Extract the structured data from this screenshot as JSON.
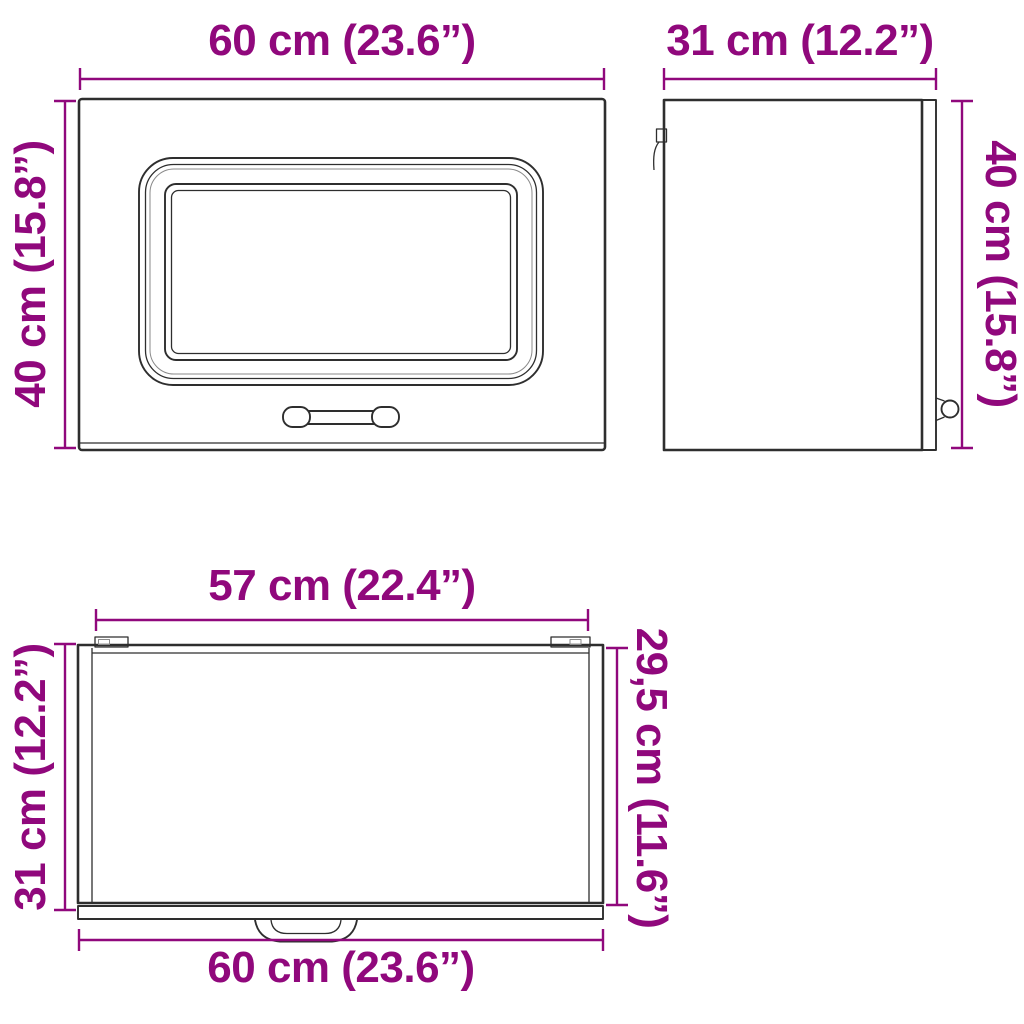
{
  "colors": {
    "dimension": "#90087c",
    "line_art": "#2e2e2e",
    "background": "#ffffff"
  },
  "views": {
    "front": {
      "width": "60 cm (23.6”)",
      "height": "40 cm (15.8”)"
    },
    "side": {
      "width": "31 cm (12.2”)",
      "height": "40 cm (15.8”)"
    },
    "top": {
      "inner_width": "57 cm (22.4”)",
      "depth": "31 cm (12.2”)",
      "inner_depth": "29,5 cm (11.6”)",
      "width": "60 cm (23.6”)"
    }
  }
}
